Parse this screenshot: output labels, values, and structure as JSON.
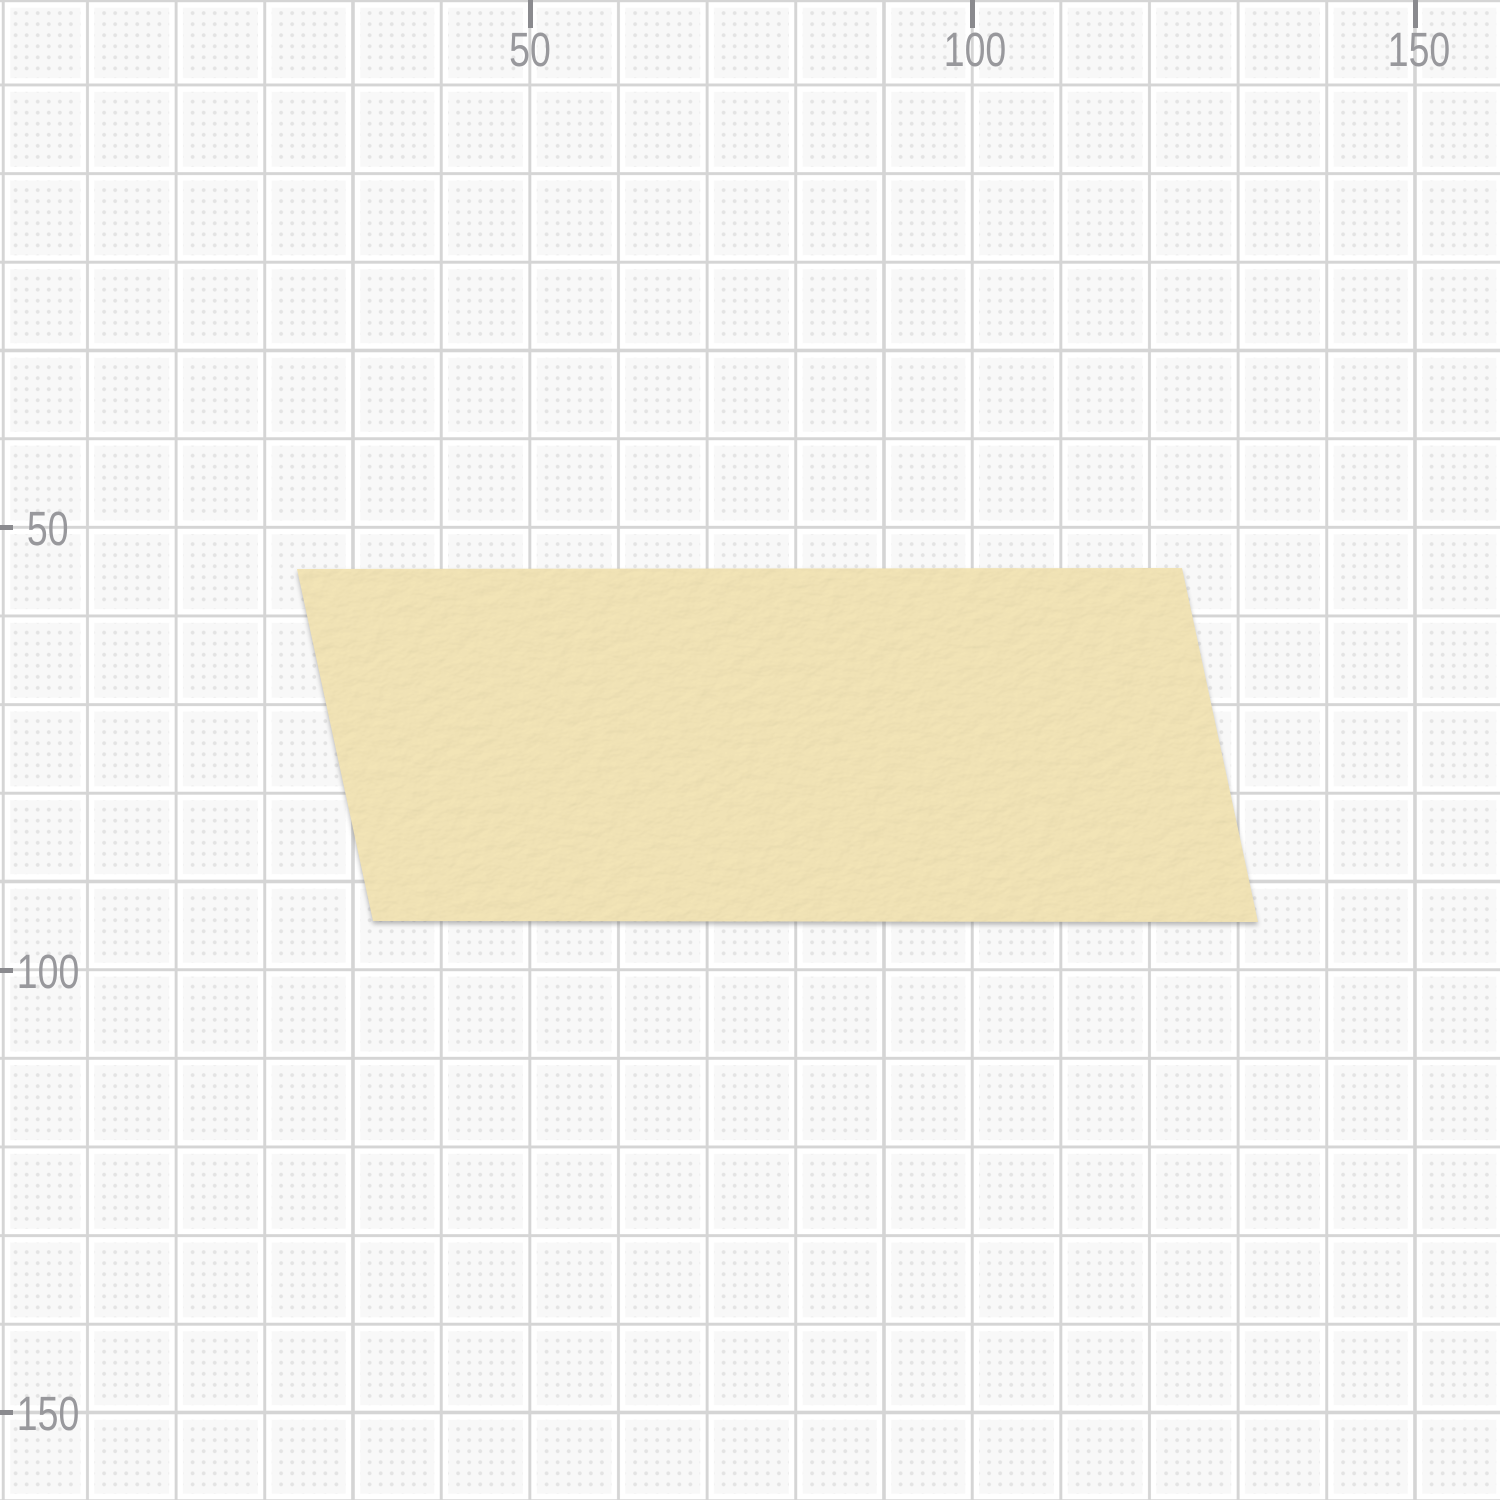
{
  "grid": {
    "background_color": "#f8f8f8",
    "major_line_color": "#d5d5d5",
    "dot_color": "#e3e3e3",
    "major_spacing_px": 88.5,
    "minor_dot_spacing_px": 11.06,
    "units_per_major_cell": 10
  },
  "rulers": {
    "tick_color": "#8a8a8e",
    "label_color": "#98989c",
    "top": [
      {
        "label": "50",
        "x": 530
      },
      {
        "label": "100",
        "x": 972.5
      },
      {
        "label": "150",
        "x": 1415
      }
    ],
    "left": [
      {
        "label": "50",
        "y": 527.5
      },
      {
        "label": "100",
        "y": 970
      },
      {
        "label": "150",
        "y": 1412.5
      }
    ]
  },
  "tape": {
    "fill": "#f3e5b7",
    "points": "297,569 1182,568 1258,922 373,921"
  }
}
